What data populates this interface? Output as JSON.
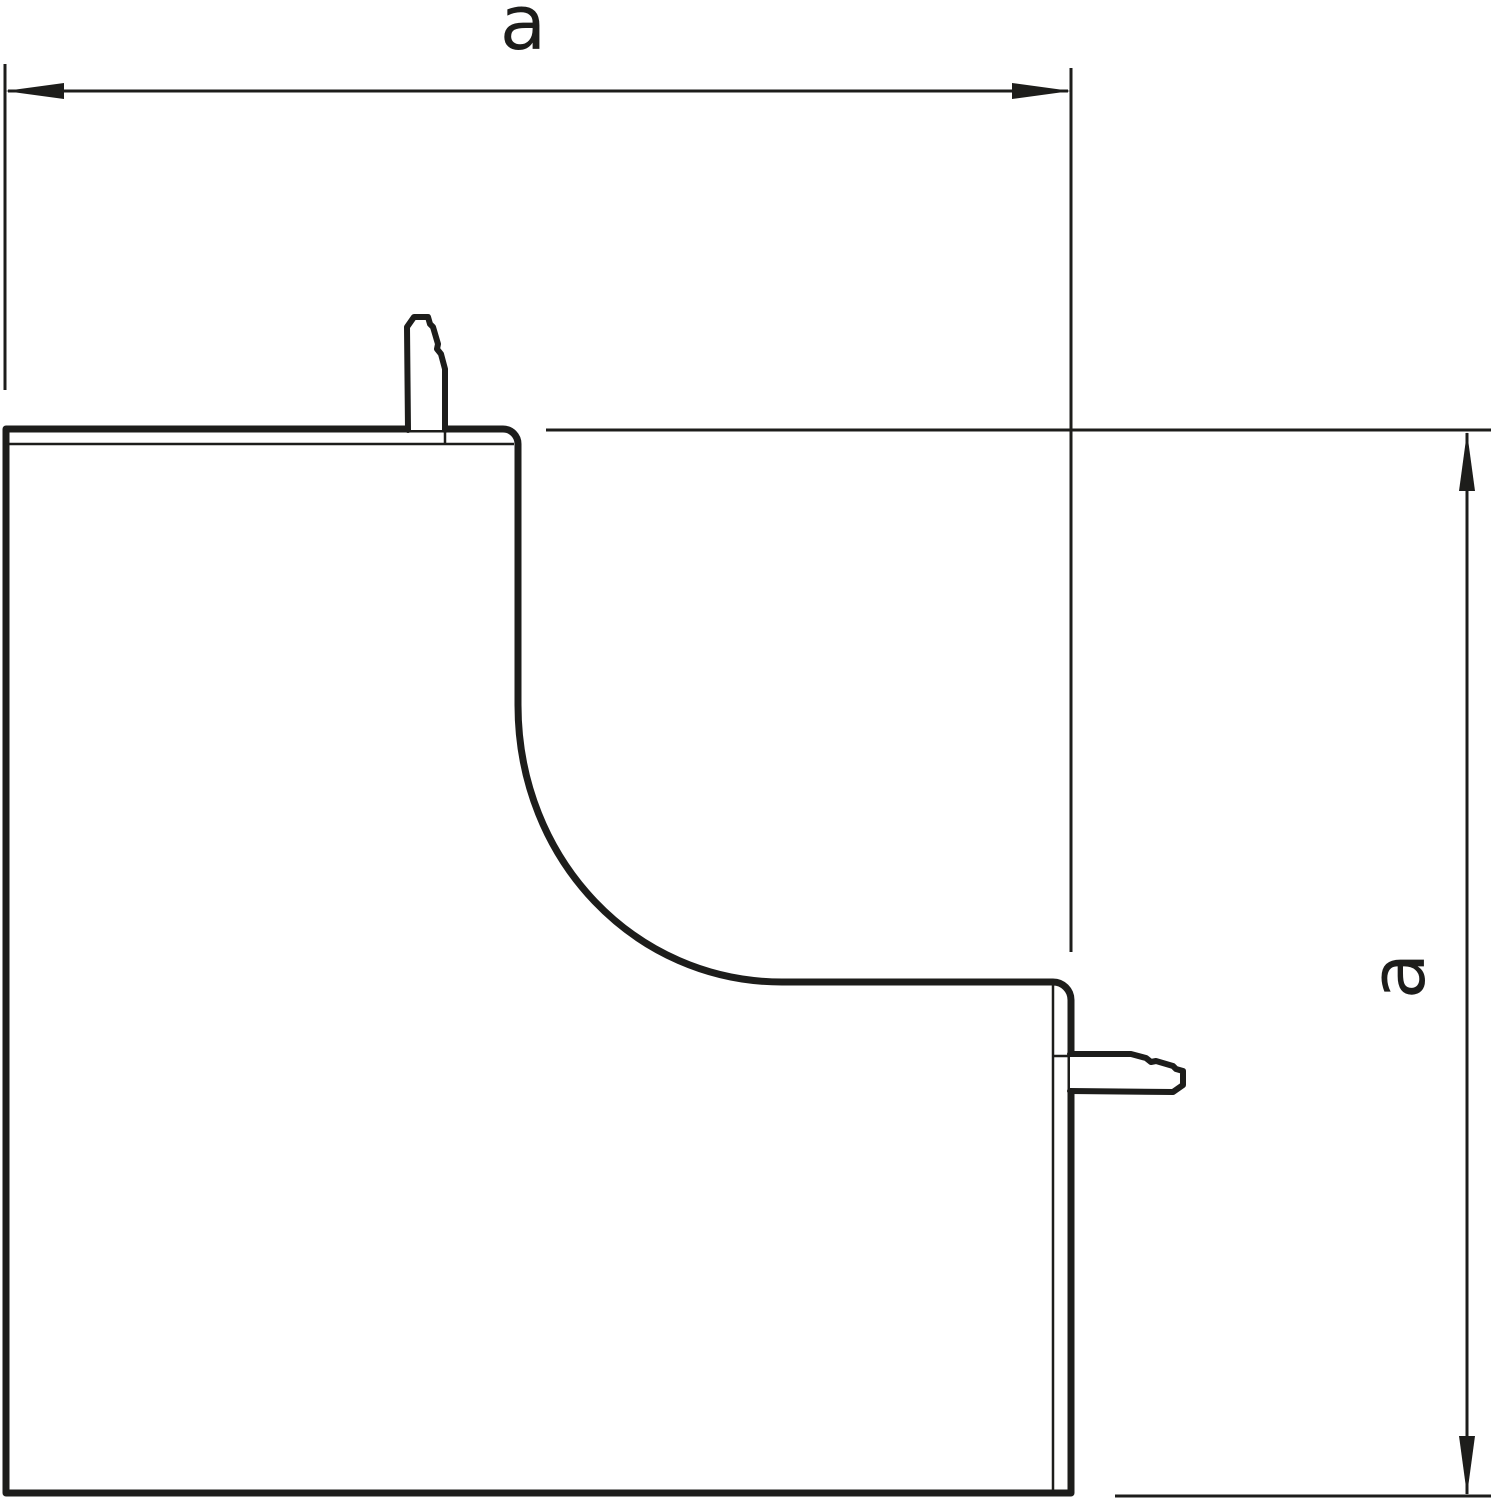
{
  "drawing": {
    "background_color": "#ffffff",
    "stroke_color": "#1d1d1b",
    "dimensions": {
      "horizontal": {
        "label": "a"
      },
      "vertical": {
        "label": "a"
      }
    }
  }
}
